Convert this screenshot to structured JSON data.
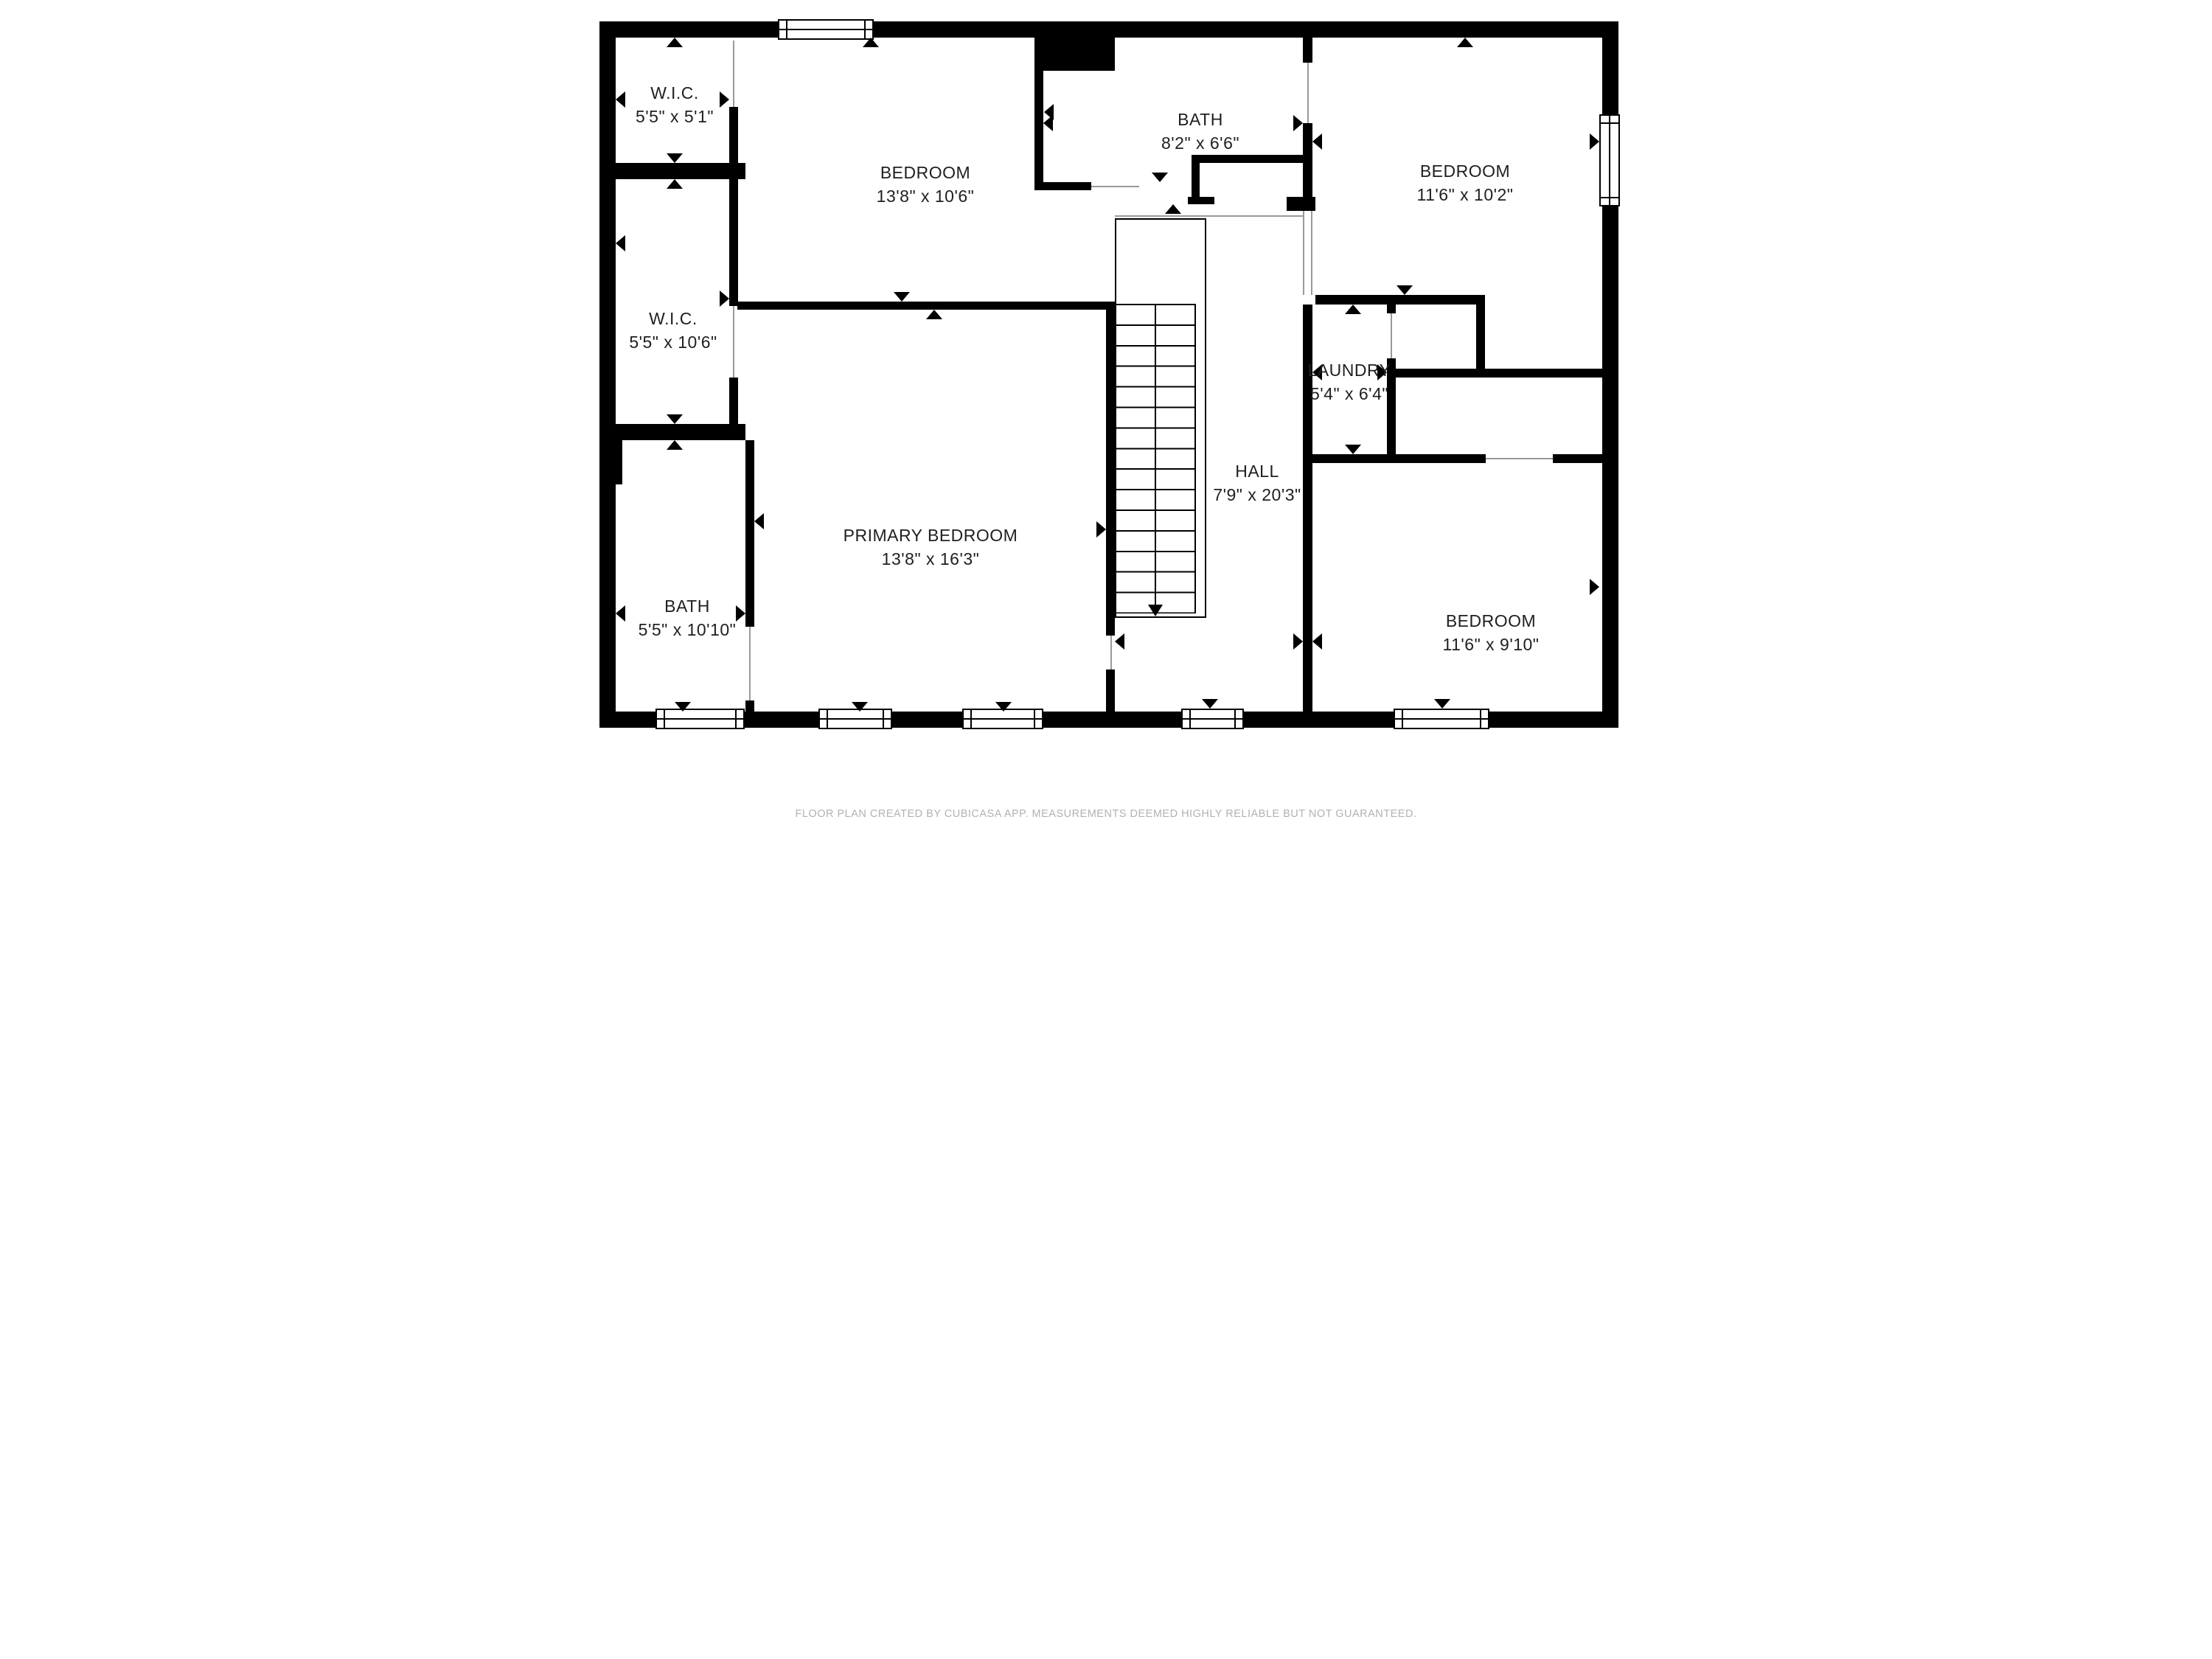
{
  "rooms": {
    "wic_top": {
      "name": "W.I.C.",
      "dims": "5'5\" x 5'1\""
    },
    "bedroom_top": {
      "name": "BEDROOM",
      "dims": "13'8\" x 10'6\""
    },
    "bath_top": {
      "name": "BATH",
      "dims": "8'2\" x 6'6\""
    },
    "bedroom_right": {
      "name": "BEDROOM",
      "dims": "11'6\" x 10'2\""
    },
    "wic_mid": {
      "name": "W.I.C.",
      "dims": "5'5\" x 10'6\""
    },
    "laundry": {
      "name": "LAUNDRY",
      "dims": "5'4\" x 6'4\""
    },
    "hall": {
      "name": "HALL",
      "dims": "7'9\" x 20'3\""
    },
    "primary_bedroom": {
      "name": "PRIMARY BEDROOM",
      "dims": "13'8\" x 16'3\""
    },
    "bath_bottom": {
      "name": "BATH",
      "dims": "5'5\" x 10'10\""
    },
    "bedroom_bottom_right": {
      "name": "BEDROOM",
      "dims": "11'6\" x 9'10\""
    }
  },
  "footer": {
    "text": "FLOOR PLAN CREATED BY CUBICASA APP. MEASUREMENTS DEEMED HIGHLY RELIABLE BUT NOT GUARANTEED."
  },
  "colors": {
    "wall": "#000000",
    "label": "#1f1f1f",
    "footer": "#b0b2b5"
  }
}
